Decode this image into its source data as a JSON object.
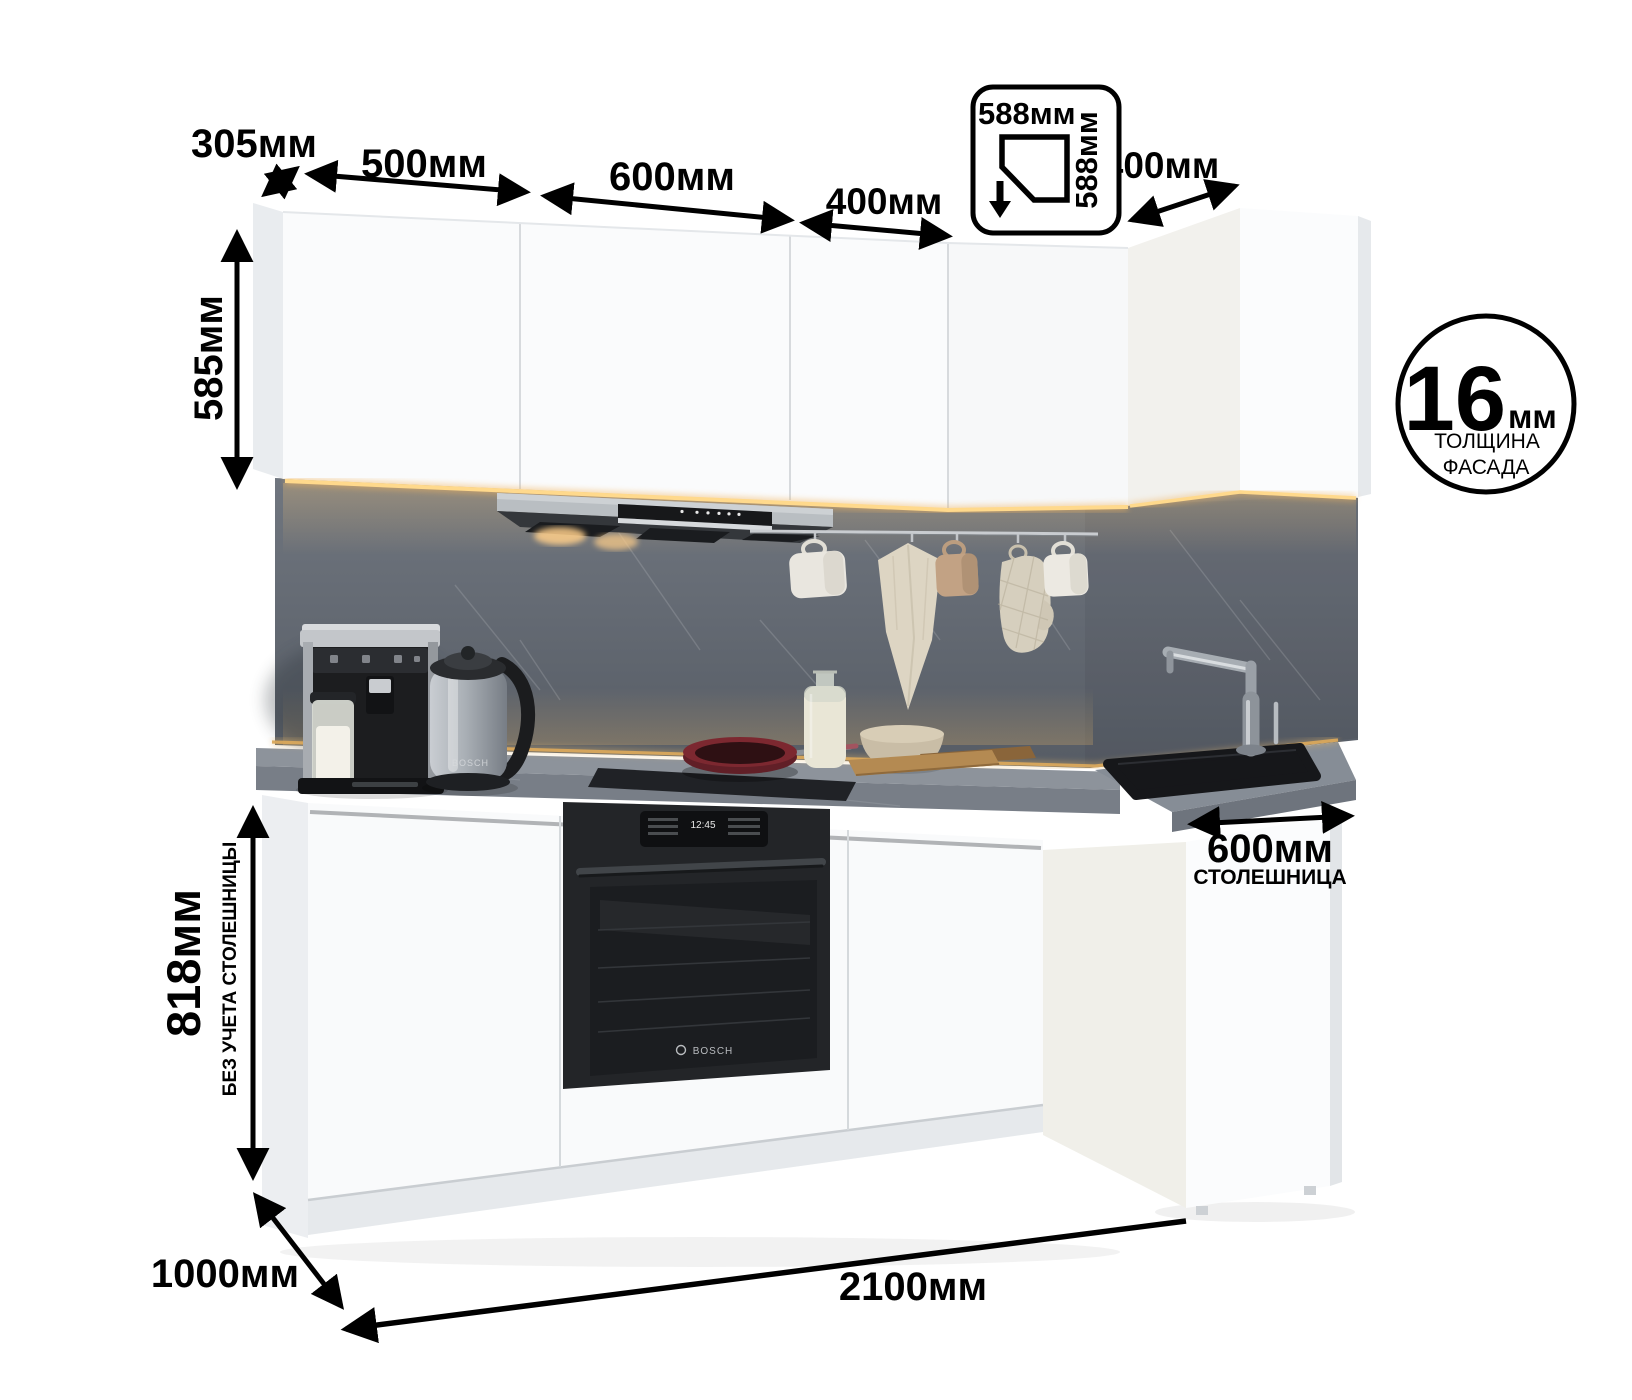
{
  "title": "Угловая кухня — схема с размерами",
  "annotations": {
    "d305": "305мм",
    "d500": "500мм",
    "d600": "600мм",
    "d400_top": "400мм",
    "d400_right": "400мм",
    "corner": {
      "w": "588мм",
      "d": "588мм",
      "icon": "corner-cabinet-plan-icon"
    },
    "d585": "585мм",
    "d818": {
      "value": "818мм",
      "note": "БЕЗ УЧЕТА СТОЛЕШНИЦЫ"
    },
    "counter": {
      "value": "600мм",
      "note": "СТОЛЕШНИЦА"
    },
    "d1000": "1000мм",
    "d2100": "2100мм",
    "facade": {
      "value": "16",
      "unit": "мм",
      "note_line1": "ТОЛЩИНА",
      "note_line2": "ФАСАДА"
    }
  },
  "appliances": {
    "oven_display_time": "12:45",
    "oven_brand": "BOSCH",
    "kettle_brand": "BOSCH"
  },
  "colors": {
    "annotation": "#000000",
    "cabinet_white": "#fafbfc",
    "backsplash_gray": "#656b74",
    "countertop_gray": "#8a9099",
    "led_warm": "#f5c06a",
    "oven_black": "#232528"
  }
}
